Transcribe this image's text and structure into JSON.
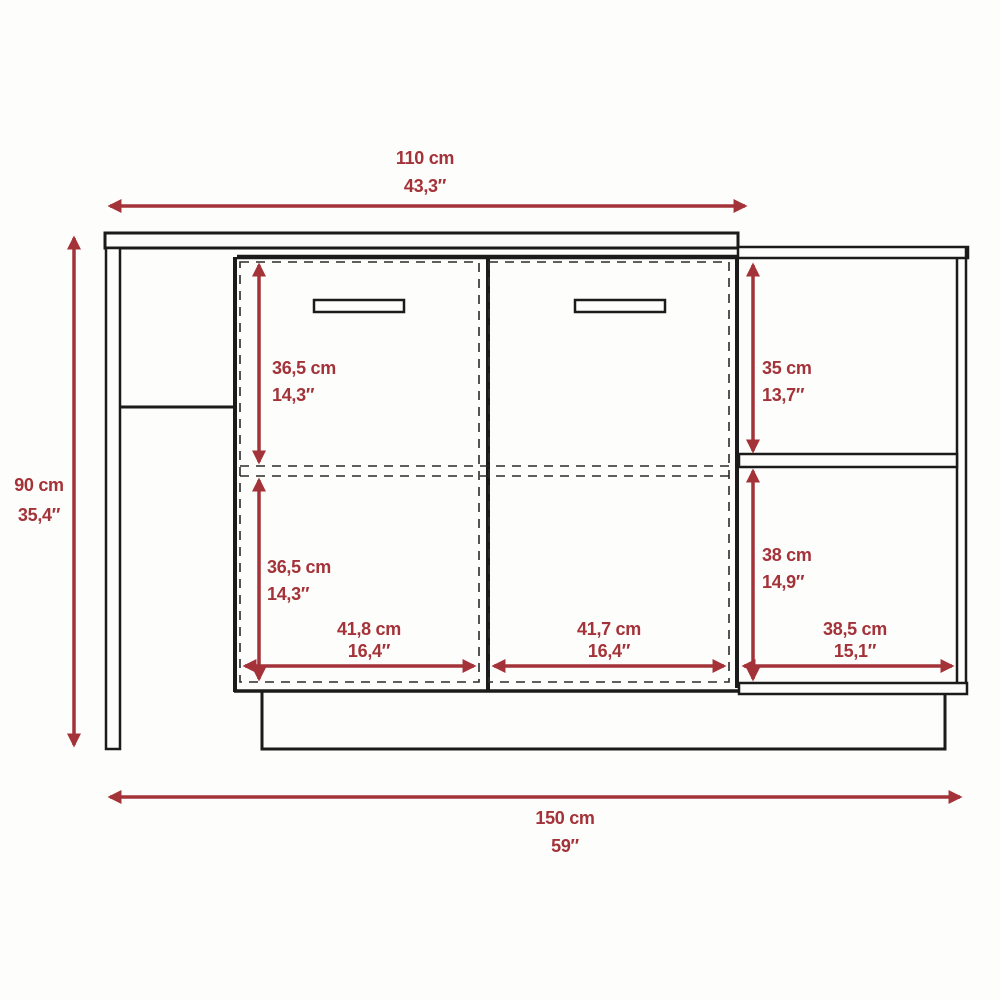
{
  "diagram": {
    "colors": {
      "dimension_red": "#a43339",
      "outline_black": "#1b1b1b",
      "background": "#fdfdfb"
    },
    "dimensions": {
      "top_width": {
        "cm": "110 cm",
        "inches": "43,3″"
      },
      "overall_height": {
        "cm": "90 cm",
        "inches": "35,4″"
      },
      "overall_width": {
        "cm": "150 cm",
        "inches": "59″"
      },
      "upper_door_height": {
        "cm": "36,5 cm",
        "inches": "14,3″"
      },
      "lower_door_height": {
        "cm": "36,5 cm",
        "inches": "14,3″"
      },
      "upper_shelf_height": {
        "cm": "35 cm",
        "inches": "13,7″"
      },
      "lower_shelf_height": {
        "cm": "38 cm",
        "inches": "14,9″"
      },
      "left_door_width": {
        "cm": "41,8 cm",
        "inches": "16,4″"
      },
      "right_door_width": {
        "cm": "41,7 cm",
        "inches": "16,4″"
      },
      "shelf_width": {
        "cm": "38,5 cm",
        "inches": "15,1″"
      }
    }
  }
}
